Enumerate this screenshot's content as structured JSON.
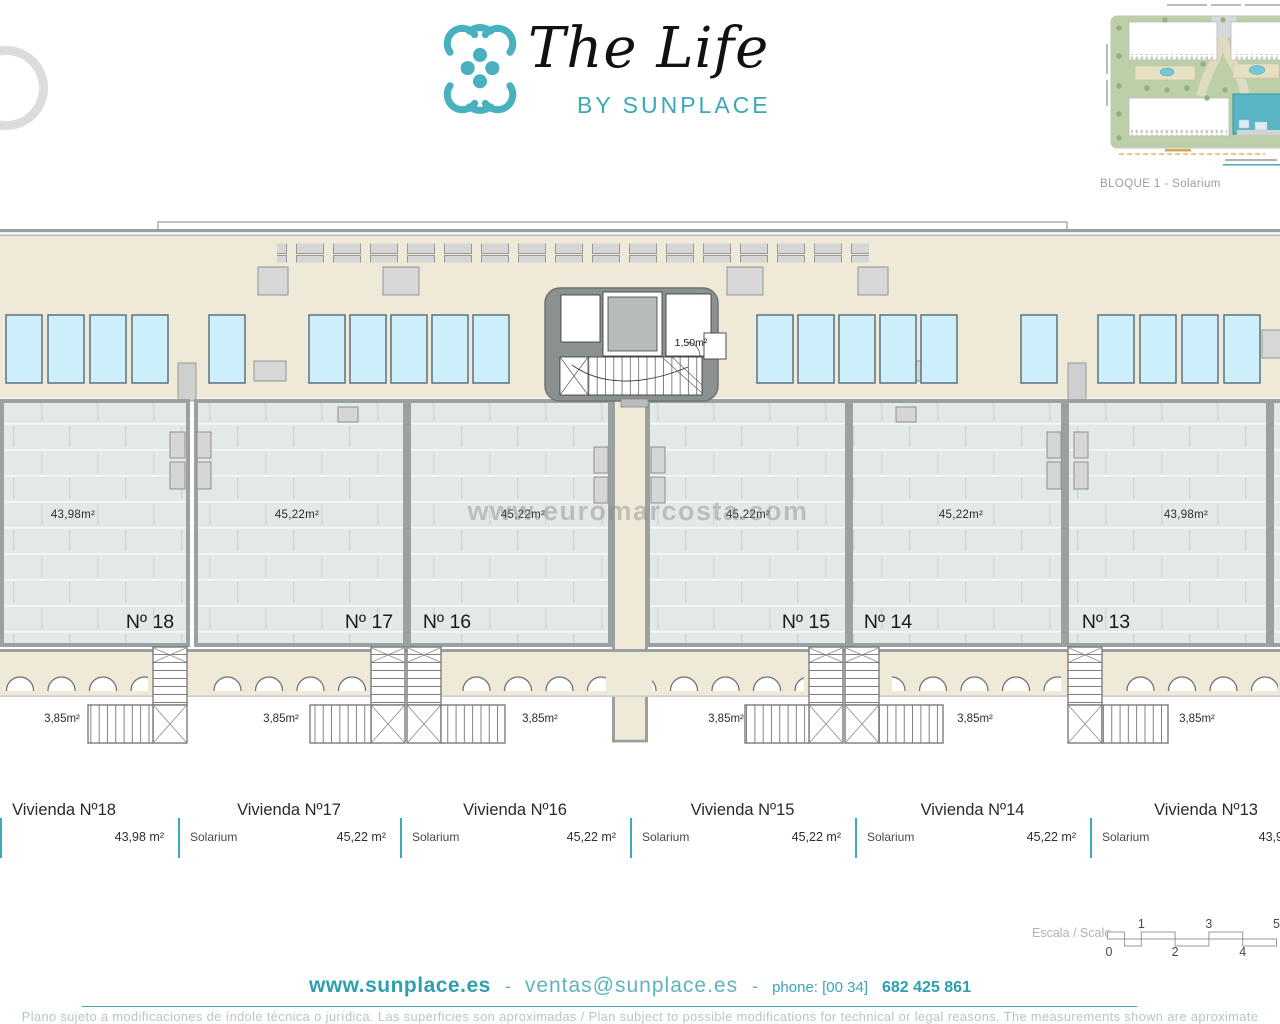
{
  "header": {
    "logo": {
      "title": "The Life",
      "subtitle": "BY SUNPLACE"
    },
    "siteplan_caption": "BLOQUE 1 - Solarium"
  },
  "plan": {
    "core_label": "1,50m²",
    "watermark": "www.euromarcosta.com",
    "units": [
      {
        "no": "Nº 18",
        "area": "43,98m²",
        "stair_area": "3,85m²"
      },
      {
        "no": "Nº 17",
        "area": "45,22m²",
        "stair_area": "3,85m²"
      },
      {
        "no": "Nº 16",
        "area": "45,22m²",
        "stair_area": "3,85m²"
      },
      {
        "no": "Nº 15",
        "area": "45,22m²",
        "stair_area": "3,85m²"
      },
      {
        "no": "Nº 14",
        "area": "45,22m²",
        "stair_area": "3,85m²"
      },
      {
        "no": "Nº 13",
        "area": "43,98m²",
        "stair_area": "3,85m²"
      }
    ]
  },
  "table": {
    "columns": [
      {
        "title": "Vivienda Nº18",
        "row_label": "Solarium",
        "value": "43,98 m²"
      },
      {
        "title": "Vivienda Nº17",
        "row_label": "Solarium",
        "value": "45,22 m²"
      },
      {
        "title": "Vivienda Nº16",
        "row_label": "Solarium",
        "value": "45,22 m²"
      },
      {
        "title": "Vivienda Nº15",
        "row_label": "Solarium",
        "value": "45,22 m²"
      },
      {
        "title": "Vivienda Nº14",
        "row_label": "Solarium",
        "value": "45,22 m²"
      },
      {
        "title": "Vivienda Nº13",
        "row_label": "Solarium",
        "value": "43,98 m²"
      }
    ]
  },
  "scale": {
    "label": "Escala / Scale",
    "ticks_top": [
      "1",
      "3",
      "5"
    ],
    "ticks_bottom": [
      "0",
      "2",
      "4"
    ]
  },
  "footer": {
    "website": "www.sunplace.es",
    "separator": "-",
    "email": "ventas@sunplace.es",
    "phone_label": "phone: [00 34]",
    "phone_number": "682 425 861",
    "disclaimer": "Plano sujeto a modificaciones de índole técnica o jurídica. Las superficies son aproximadas / Plan subject to possible modifications for technical or legal reasons. The measurements  shown are aproximate"
  },
  "colors": {
    "accent_teal": "#3aa8b8",
    "solar_panel_blue": "#cdeefb",
    "roof_beige": "#efe9d7",
    "terrace_tile": "#e3e9e8",
    "wall_gray": "#9ba1a1",
    "core_gray": "#8b9191",
    "highlighted_building": "#5ab5c7"
  }
}
